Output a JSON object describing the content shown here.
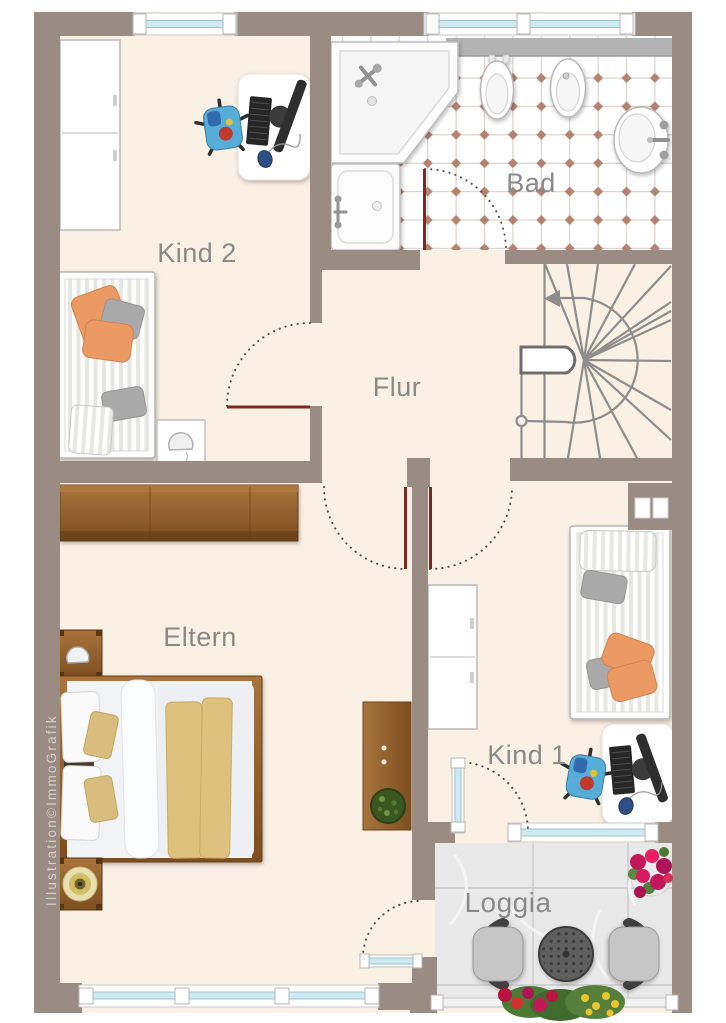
{
  "watermark": "Illustration©ImmoGrafik",
  "rooms": [
    {
      "id": "kind2",
      "label": "Kind 2",
      "furniture": [
        "wardrobe",
        "desk with computer",
        "office chair",
        "single bed",
        "nightstand with lamp"
      ]
    },
    {
      "id": "bad",
      "label": "Bad",
      "furniture": [
        "corner bathtub",
        "shower",
        "toilet",
        "bidet",
        "washbasin",
        "shelf"
      ]
    },
    {
      "id": "flur",
      "label": "Flur",
      "furniture": [
        "winder staircase with up arrow"
      ]
    },
    {
      "id": "eltern",
      "label": "Eltern",
      "furniture": [
        "wardrobe",
        "double bed",
        "nightstand with lamp",
        "nightstand with gold plate"
      ]
    },
    {
      "id": "kind1",
      "label": "Kind 1",
      "furniture": [
        "single bed",
        "desk with computer",
        "office chair",
        "wardrobe",
        "chest with plant"
      ]
    },
    {
      "id": "loggia",
      "label": "Loggia",
      "furniture": [
        "garden chair",
        "round table",
        "garden chair",
        "flower pot",
        "flower box"
      ]
    }
  ],
  "colors": {
    "wall": "#9a8b83",
    "floor": "#fbf0e4",
    "tile-accent": "#b5826f",
    "tile-line": "#d2c8c2",
    "loggia-floor": "#e9e9e9",
    "wood-1": "#a8743c",
    "wood-2": "#7d4e20",
    "stripe": "#e6e6e2",
    "orange": "#eb9a63",
    "gray-pillow": "#a9a9a9",
    "blanket": "#ddc17c",
    "glass": "#cde9f2",
    "glass-edge": "#9fc3cf",
    "door-leaf": "#7b2a22",
    "arc-color": "#4a4a4a",
    "label": "#8a8a8a",
    "stair": "#8d8d8d",
    "watermark-color": "#d5d0cb"
  }
}
